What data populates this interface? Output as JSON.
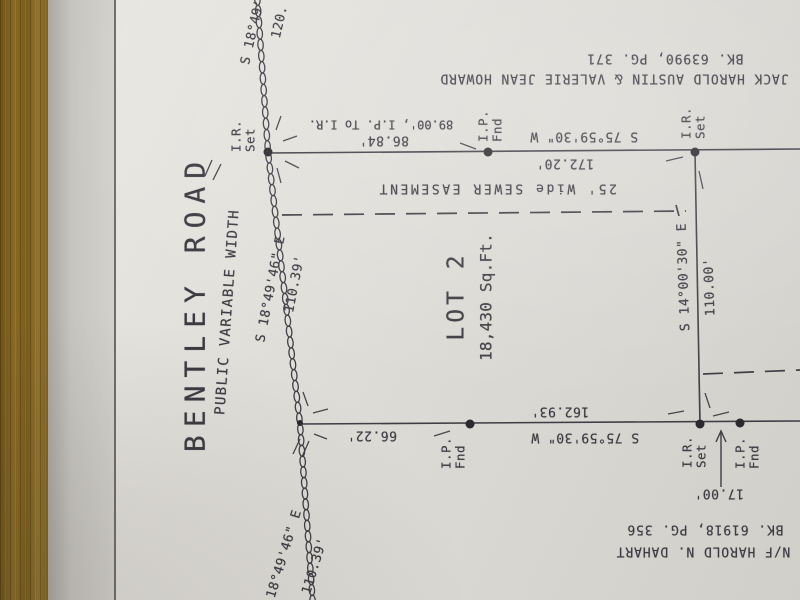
{
  "plat": {
    "road": {
      "name": "BENTLEY ROAD",
      "width_note": "PUBLIC VARIABLE WIDTH",
      "segments": {
        "top": {
          "bearing": "S 18°49'",
          "distance": "120."
        },
        "middle": {
          "bearing": "S 18°49'46\" E",
          "distance": "110.39'"
        },
        "bottom": {
          "bearing": "S 18°49'46\" E",
          "distance": "110.39'"
        }
      }
    },
    "lot": {
      "name": "LOT 2",
      "area": "18,430 Sq.Ft."
    },
    "north_line": {
      "bearing": "S 75°59'30\" W",
      "distance_1": "86.84'",
      "note": "89.00', I.P. To I.R.",
      "distance_2": "172.20'"
    },
    "east_line": {
      "bearing": "S 14°00'30\" E",
      "distance": "110.00'"
    },
    "south_line": {
      "bearing": "S 75°59'30\" W",
      "distance_1": "162.93'",
      "distance_2": "66.22'",
      "offset": "17.00'"
    },
    "easement": {
      "label": "25' Wide SEWER EASEMENT"
    },
    "adjoiner_north": {
      "owner": "JACK HAROLD AUSTIN & VALERIE JEAN HOWARD",
      "deed": "BK. 63990, PG. 371"
    },
    "adjoiner_south": {
      "owner": "N/F HAROLD N. DAHART",
      "deed": "BK. 61918, PG. 356"
    },
    "markers": {
      "iron_rod_set_line1": "I.R.",
      "iron_rod_set_line2": "Set",
      "iron_pipe_found_line1": "I.P.",
      "iron_pipe_found_line2": "Fnd"
    },
    "ink_color": "#3c3c42"
  }
}
